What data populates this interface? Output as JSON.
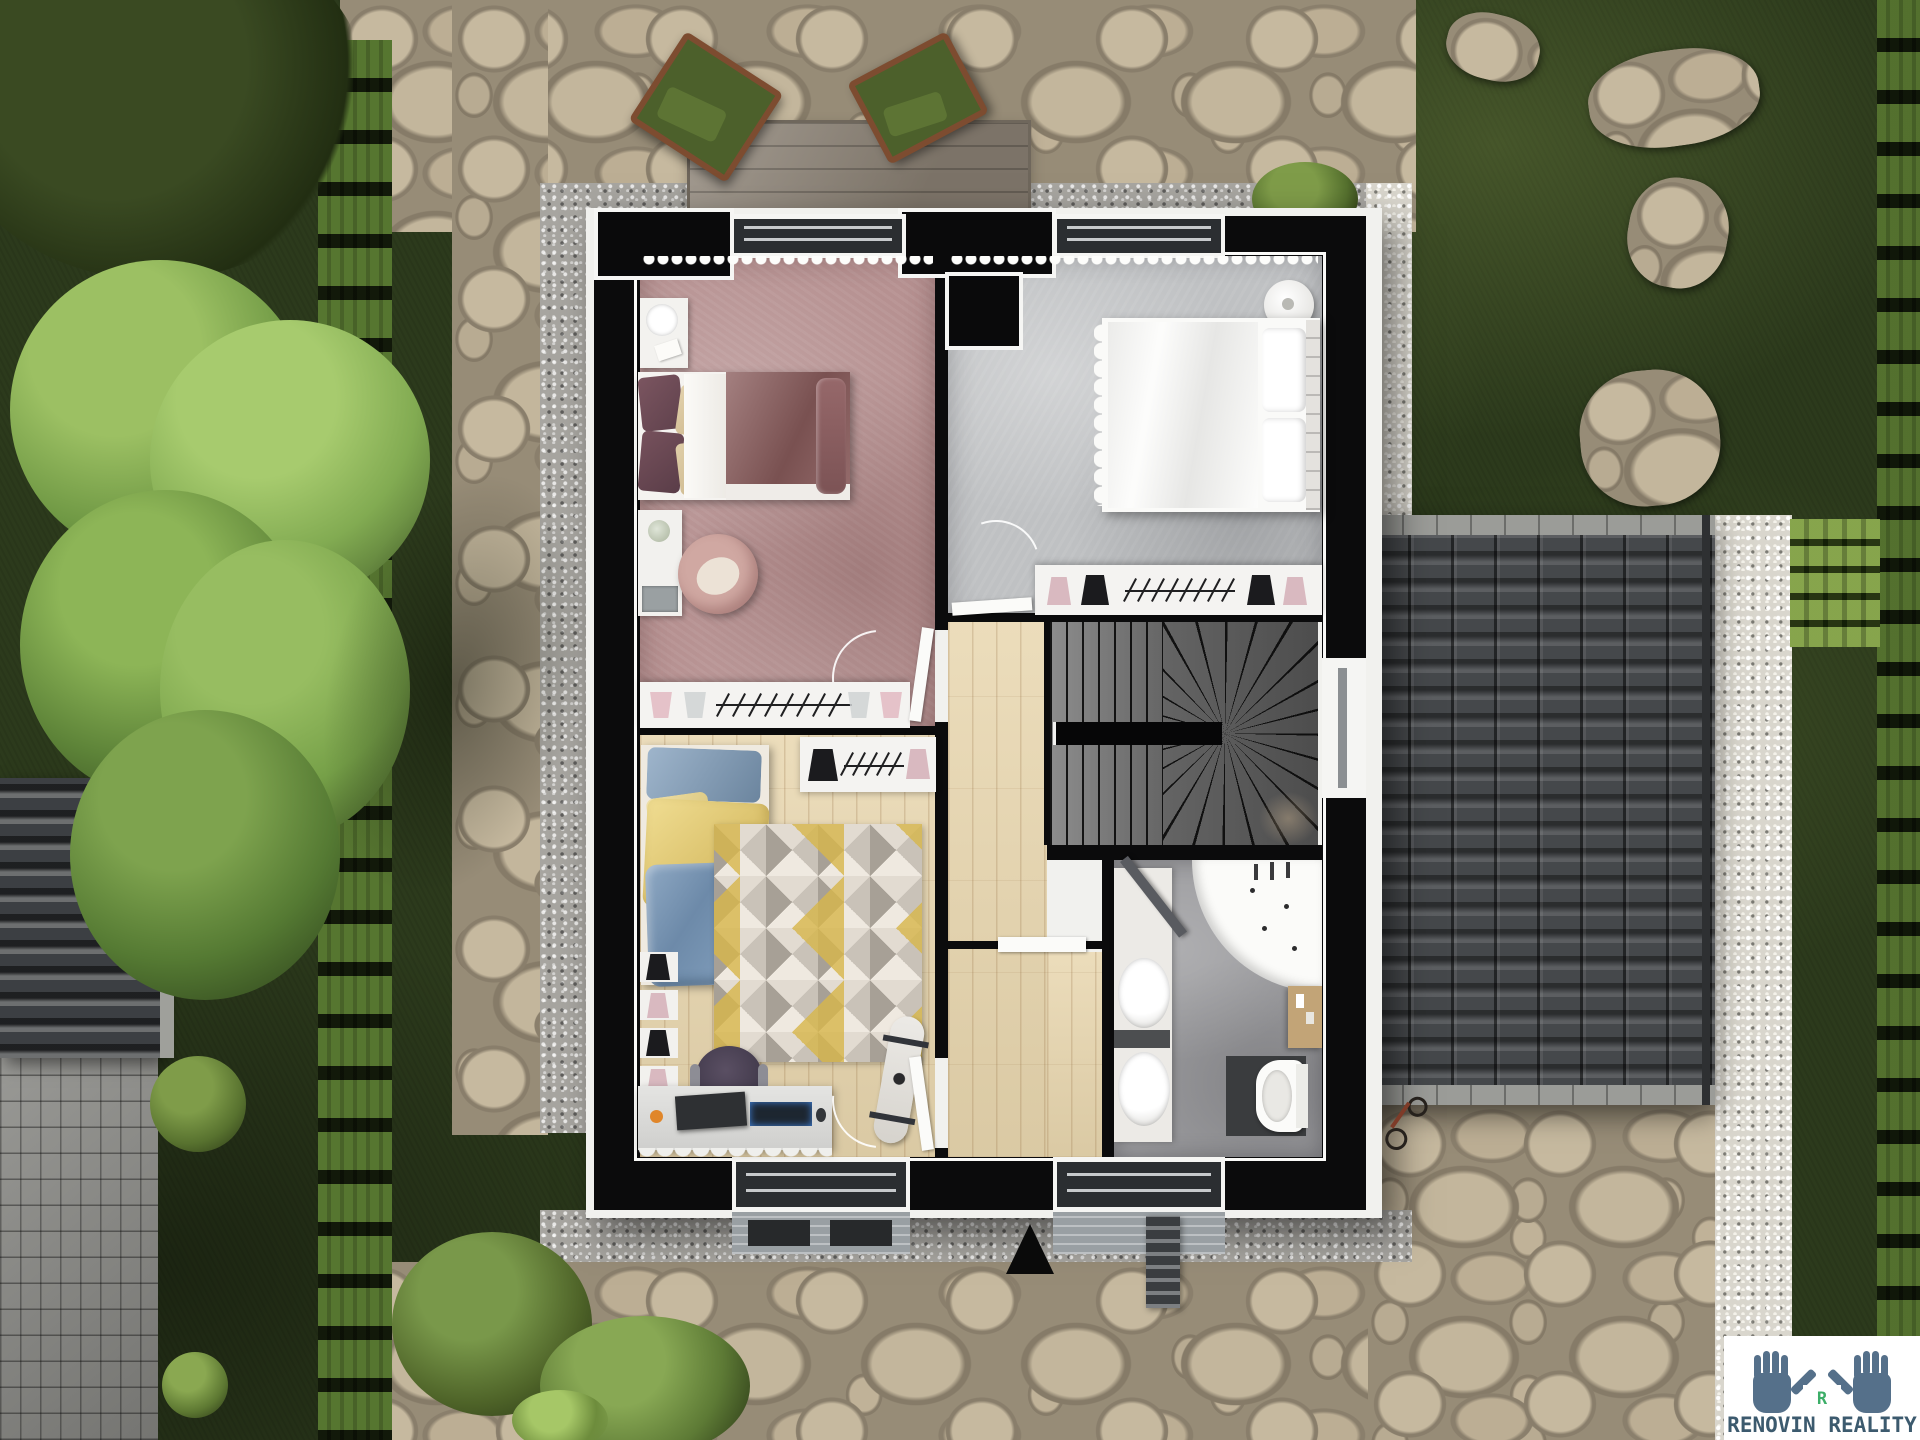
{
  "scene": {
    "type": "top-down 3D rendered floor plan of a house upper storey with garden",
    "logo": {
      "text": "RENOVIN REALITY",
      "initial": "R"
    },
    "rooms": [
      {
        "id": "bedroom-pink",
        "name": "pink bedroom"
      },
      {
        "id": "bedroom-gray",
        "name": "gray bedroom"
      },
      {
        "id": "kids-room",
        "name": "kids room"
      },
      {
        "id": "hallway",
        "name": "hallway"
      },
      {
        "id": "staircase",
        "name": "staircase"
      },
      {
        "id": "bathroom",
        "name": "bathroom"
      }
    ],
    "colors": {
      "wall": "#0b0b0c",
      "floor_pink": "#b69191",
      "floor_gray": "#bfc1c3",
      "floor_wood": "#e8d6ae",
      "floor_bath": "#9c9c9f",
      "stairs": "#6e6e6e",
      "roof": "#45484b",
      "grass": "#2c3a1c",
      "stone": "#b2a68f",
      "gravel_white": "#d9d6cd",
      "hedge": "#243216",
      "rug_yellow": "#d7b64b",
      "kids_blue": "#7e9cba",
      "kids_yellow": "#e9d382",
      "duvet_mauve": "#8a5c5c",
      "logo_hands": "#55708a",
      "logo_initial": "#3cae68",
      "logo_text": "#3c5a6e"
    }
  }
}
